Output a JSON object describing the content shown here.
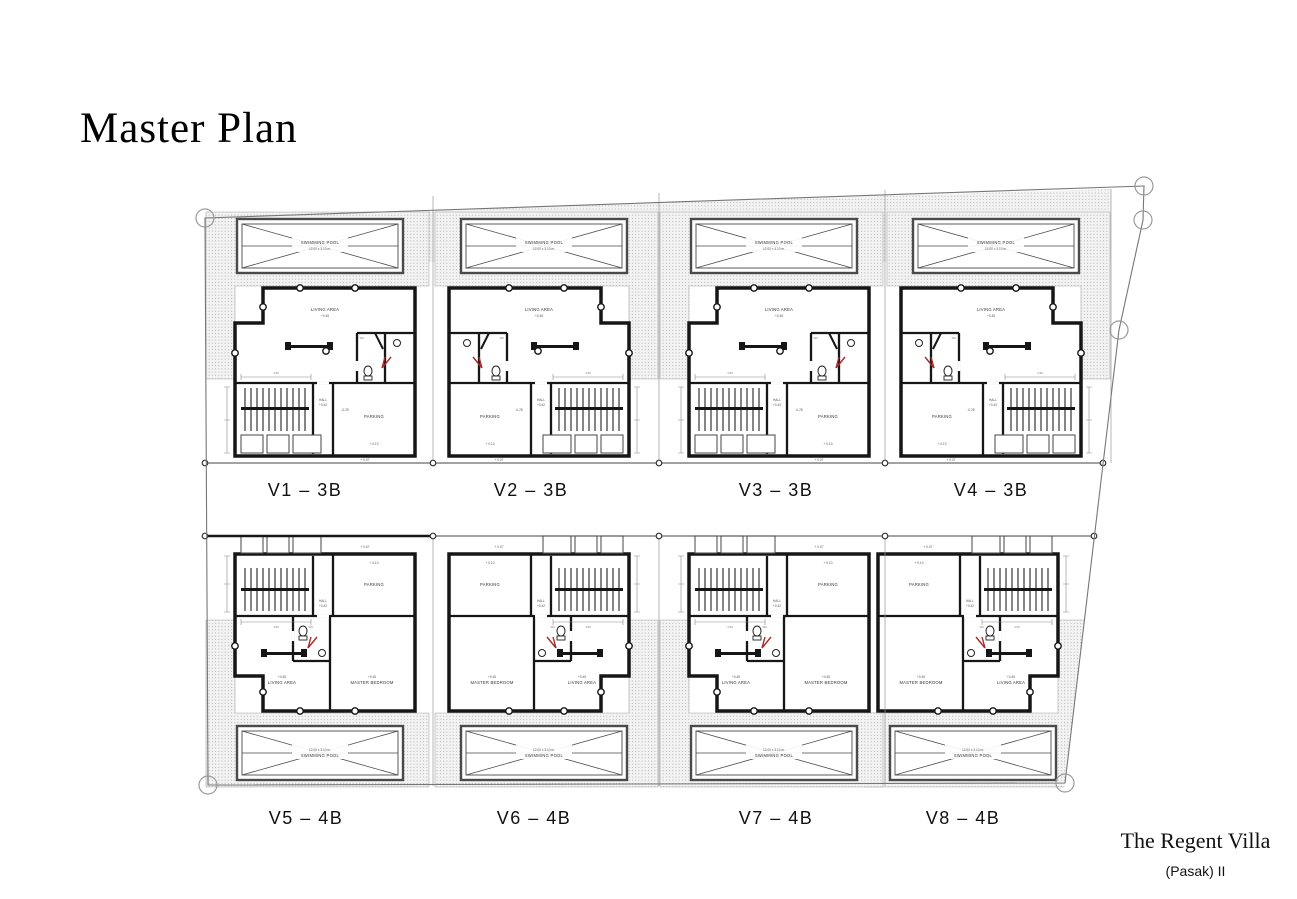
{
  "page": {
    "title": "Master Plan"
  },
  "footer": {
    "project_name": "The Regent Villa",
    "project_phase": "(Pasak) II"
  },
  "site": {
    "rows": [
      {
        "name": "row-1",
        "villas": [
          {
            "id": "V1",
            "label": "V1 – 3B"
          },
          {
            "id": "V2",
            "label": "V2 – 3B"
          },
          {
            "id": "V3",
            "label": "V3 – 3B"
          },
          {
            "id": "V4",
            "label": "V4 – 3B"
          }
        ]
      },
      {
        "name": "row-2",
        "villas": [
          {
            "id": "V5",
            "label": "V5 – 4B"
          },
          {
            "id": "V6",
            "label": "V6 – 4B"
          },
          {
            "id": "V7",
            "label": "V7 – 4B"
          },
          {
            "id": "V8",
            "label": "V8 – 4B"
          }
        ]
      }
    ]
  },
  "plan": {
    "rooms": {
      "living_area": "LIVING AREA",
      "hall": "HALL",
      "parking": "PARKING",
      "master_bedroom": "MASTER BEDROOM",
      "wc": "WC"
    },
    "pool": {
      "line1": "SWIMMING POOL",
      "line2": "12.00 x 3.10 m."
    },
    "levels": {
      "living": "+0.45",
      "hall": "+0.42",
      "step": "-0.25",
      "parking": "+ 0.10",
      "drive": "+ 0.07"
    },
    "dims": {
      "stair_total": "4.50"
    }
  },
  "colors": {
    "wall": "#161616",
    "pool_line": "#4a4a4a",
    "boundary": "#777777",
    "hatch_dot": "#b5b5b5",
    "accent_red": "#a82a2a",
    "text": "#111111"
  }
}
